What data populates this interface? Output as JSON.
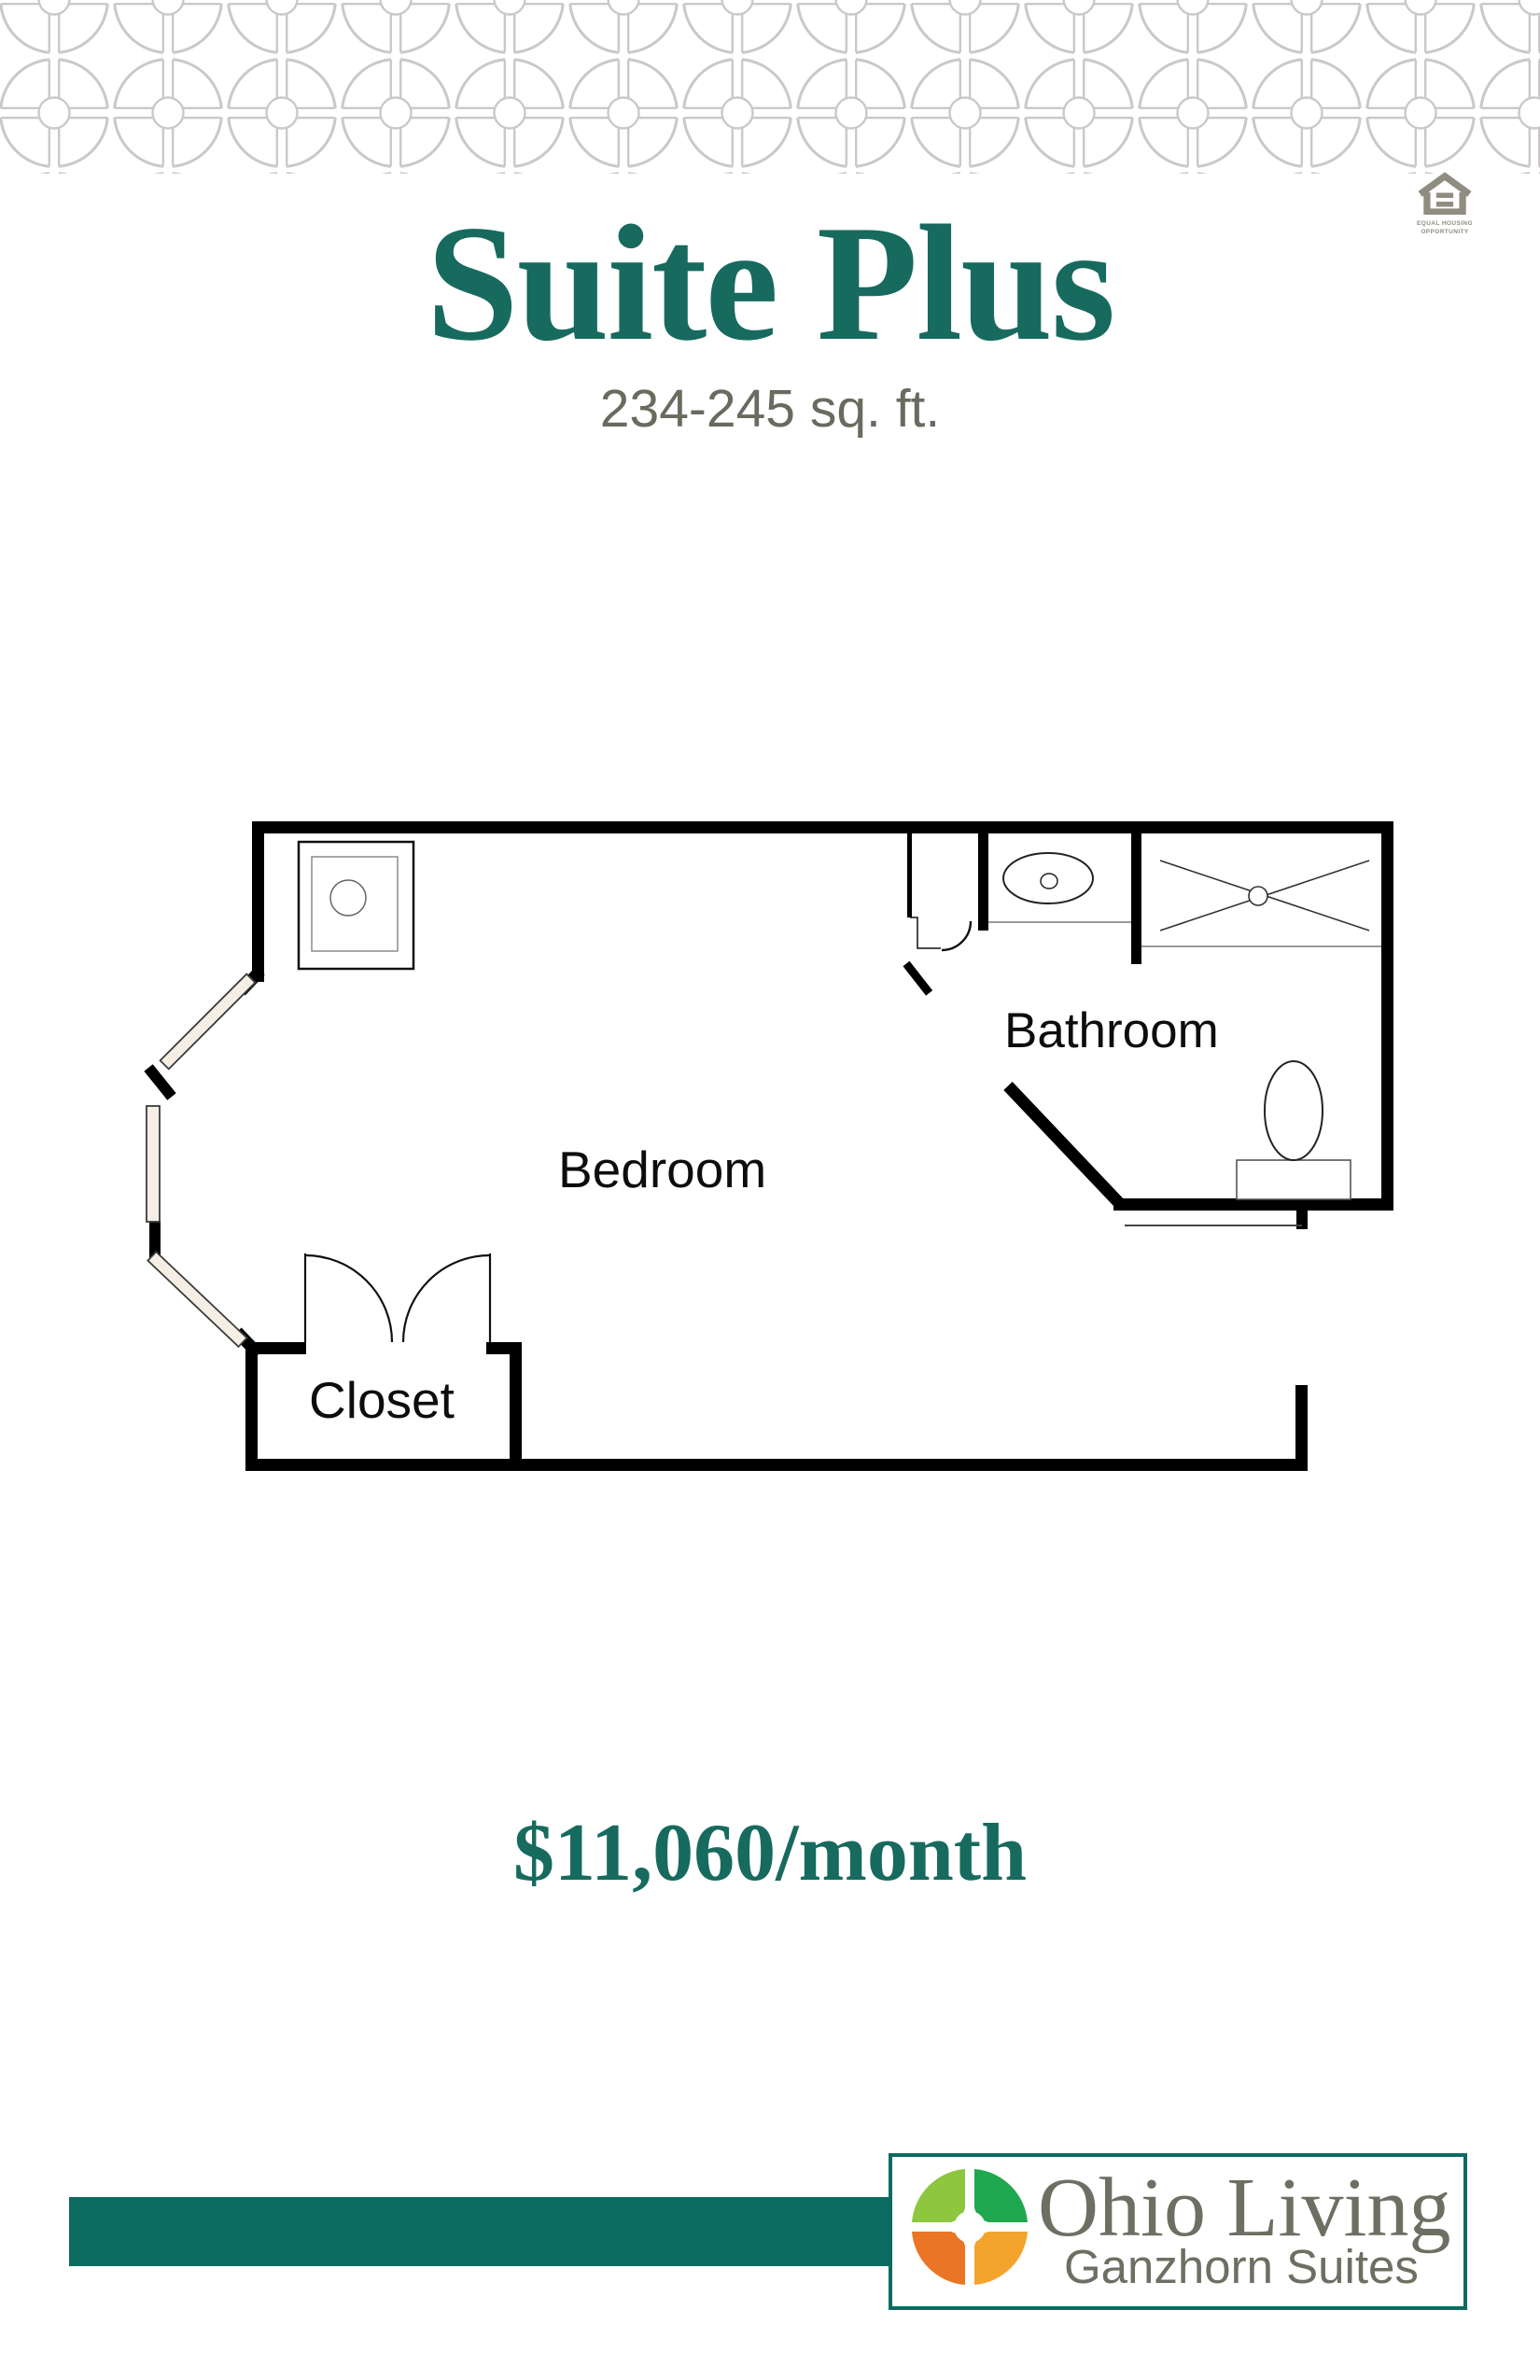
{
  "header": {
    "title": "Suite Plus",
    "subtitle": "234-245 sq. ft."
  },
  "equal_housing": {
    "line1": "EQUAL HOUSING",
    "line2": "OPPORTUNITY"
  },
  "floor_plan": {
    "labels": {
      "bedroom": "Bedroom",
      "bathroom": "Bathroom",
      "closet": "Closet"
    }
  },
  "price": {
    "text": "$11,060/month"
  },
  "footer": {
    "brand": "Ohio Living",
    "sub_brand": "Ganzhorn Suites"
  },
  "colors": {
    "teal_text": "#176a5e",
    "subtitle_gray": "#6b6a5e",
    "teal_bar": "#0b6b60",
    "logo_text_gray": "#6f6e62",
    "pattern_gray": "#cac8c9",
    "eho_gray": "#8f8d80",
    "wall_black": "#000000",
    "window_fill": "#f4eee4",
    "logo_quadrants": {
      "top_left": "#8dc63f",
      "top_right": "#1fa84f",
      "bottom_left": "#e97525",
      "bottom_right": "#f3a42c"
    }
  }
}
